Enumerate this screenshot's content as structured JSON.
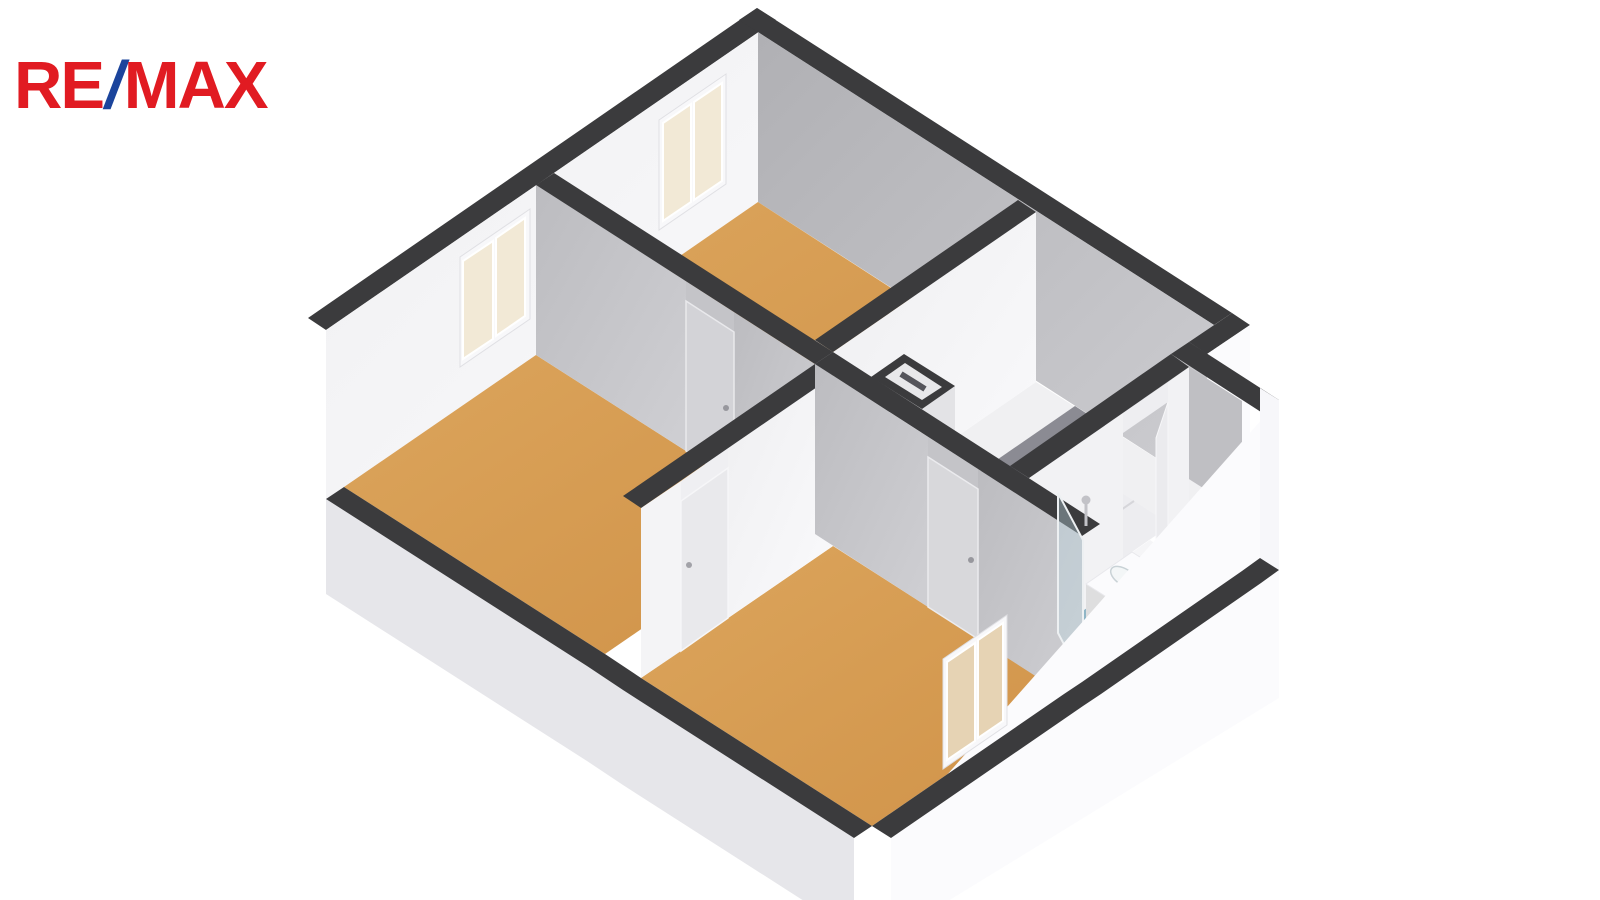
{
  "logo": {
    "re": "RE",
    "slash": "/",
    "max": "MAX"
  },
  "colors": {
    "background": "#ffffff",
    "logo_red": "#e11b22",
    "logo_blue": "#1b449c",
    "wall_top_band": "#3b3b3d",
    "wall_gray_face": "#b9b9bd",
    "wall_white_face": "#f4f4f6",
    "floor_wood": "#d59c51",
    "floor_hall": "#f0f0f2",
    "floor_bath": "#8fb5c6",
    "window_pane": "#f2e9d6",
    "skirt_gray": "#e6e6ea",
    "skirt_white": "#fbfbfd"
  },
  "floorplan": {
    "type": "3d-axonometric-floor-plan",
    "rooms": [
      {
        "id": "bedroom-top",
        "floor": "wood"
      },
      {
        "id": "bedroom-left",
        "floor": "wood"
      },
      {
        "id": "bedroom-bottom",
        "floor": "wood"
      },
      {
        "id": "hall-landing",
        "floor": "light"
      },
      {
        "id": "stairwell",
        "floor": "light",
        "feature": "winder-stairs"
      },
      {
        "id": "bathroom",
        "floor": "blue",
        "fixtures": [
          "vanity-sink",
          "toilet",
          "shower-glass-screen",
          "shower-head"
        ]
      }
    ],
    "windows": 3,
    "doors": 4
  },
  "scene": [
    {
      "n": "window-a-outer-casing",
      "t": "poly",
      "p": "706,54 632,105 632,221 706,170",
      "f": "#fdfdfe",
      "s": "#e3e3e7",
      "w": 1
    },
    {
      "n": "window-b-outer-casing",
      "t": "poly",
      "p": "509,190 433,243 433,359 509,306",
      "f": "#fdfdfe",
      "s": "#e3e3e7",
      "w": 1
    },
    {
      "n": "wall-nw-top-band",
      "t": "poly",
      "p": "757,8 776,20 326,330 308,318",
      "f": "#3b3b3d"
    },
    {
      "n": "wall-nw-interior-face",
      "t": "poly",
      "p": "776,20 326,330 326,500 776,190",
      "f": "url(#gWhiteWall)"
    },
    {
      "n": "window-a-frame",
      "t": "poly",
      "p": "726,74 659,120 659,230 726,184",
      "f": "#f8f8fa",
      "s": "#e0e0e4",
      "w": 1
    },
    {
      "n": "window-a-pane-1",
      "t": "poly",
      "p": "722,83 694,102 694,200 722,181",
      "f": "#f2e9d6",
      "s": "#ffffff",
      "w": 2
    },
    {
      "n": "window-a-pane-2",
      "t": "poly",
      "p": "691,104 663,123 663,221 691,202",
      "f": "#f2e9d6",
      "s": "#ffffff",
      "w": 2
    },
    {
      "n": "window-b-frame",
      "t": "poly",
      "p": "530,209 460,257 460,367 530,319",
      "f": "#f8f8fa",
      "s": "#e0e0e4",
      "w": 1
    },
    {
      "n": "window-b-pane-1",
      "t": "poly",
      "p": "525,218 496,238 496,336 525,316",
      "f": "#f2e9d6",
      "s": "#ffffff",
      "w": 2
    },
    {
      "n": "window-b-pane-2",
      "t": "poly",
      "p": "493,241 463,261 463,359 493,339",
      "f": "#f2e9d6",
      "s": "#ffffff",
      "w": 2
    },
    {
      "n": "wall-ne-top-band",
      "t": "poly",
      "p": "757,8 1232,313 1214,325 739,20",
      "f": "#3b3b3d"
    },
    {
      "n": "wall-ne-interior-face",
      "t": "poly",
      "p": "758,32 1214,325 1214,495 758,202",
      "f": "url(#gGrayWall)"
    },
    {
      "n": "wall-step-top-band",
      "t": "poly",
      "p": "1232,313 1250,325 1207,354 1189,342",
      "f": "#3b3b3d"
    },
    {
      "n": "wall-step-east-face",
      "t": "poly",
      "p": "1250,325 1207,354 1207,619 1250,590",
      "f": "#fbfbfd"
    },
    {
      "n": "wall-bath-north-top-band",
      "t": "poly",
      "p": "1189,342 1279,400 1261,412 1171,354",
      "f": "#3b3b3d"
    },
    {
      "n": "wall-bath-north-interior-face",
      "t": "poly",
      "p": "1189,367 1242,401 1242,571 1189,537",
      "f": "#bfbfc3"
    },
    {
      "n": "floor-bedroom-top",
      "t": "poly",
      "p": "758,202 1018,370 815,510 554,343",
      "f": "url(#gTan)"
    },
    {
      "n": "floor-bedroom-left",
      "t": "poly",
      "p": "536,355 797,522 605,654 344,487",
      "f": "url(#gTan)"
    },
    {
      "n": "floor-hall-landing",
      "t": "poly",
      "p": "1036,382 1214,495 1010,636 833,522",
      "f": "#f0f0f2"
    },
    {
      "n": "floor-bathroom",
      "t": "poly",
      "p": "1189,537 1242,571 1082,682 1029,648",
      "f": "#8fb5c6"
    },
    {
      "n": "floor-bedroom-bottom",
      "t": "poly",
      "p": "833,546 1064,694 872,826 641,678",
      "f": "url(#gTan)"
    },
    {
      "n": "bathroom-door-threshold",
      "t": "poly",
      "p": "1150,540 1168,552 1123,583 1105,571",
      "f": "#f5f5f7"
    },
    {
      "n": "stair-zone",
      "t": "poly",
      "p": "1066,457 1171,525 1010,636 905,568",
      "f": "#ededf0"
    },
    {
      "n": "stair-tread-seam-1",
      "t": "line",
      "x1": 1083,
      "y1": 468,
      "x2": 922,
      "y2": 579,
      "s": "#d6d6da",
      "w": 2
    },
    {
      "n": "stair-tread-seam-2",
      "t": "line",
      "x1": 1100,
      "y1": 479,
      "x2": 939,
      "y2": 590,
      "s": "#d6d6da",
      "w": 2
    },
    {
      "n": "stair-tread-seam-3",
      "t": "line",
      "x1": 1117,
      "y1": 490,
      "x2": 956,
      "y2": 601,
      "s": "#d6d6da",
      "w": 2
    },
    {
      "n": "stair-tread-seam-4",
      "t": "line",
      "x1": 1134,
      "y1": 501,
      "x2": 973,
      "y2": 612,
      "s": "#d6d6da",
      "w": 2
    },
    {
      "n": "stair-winder-seam-1",
      "t": "line",
      "x1": 993,
      "y1": 614,
      "x2": 963,
      "y2": 529,
      "s": "#d9d9dd",
      "w": 2
    },
    {
      "n": "stair-winder-seam-2",
      "t": "line",
      "x1": 993,
      "y1": 614,
      "x2": 930,
      "y2": 551,
      "s": "#d9d9dd",
      "w": 2
    },
    {
      "n": "stair-winder-seam-3",
      "t": "line",
      "x1": 993,
      "y1": 614,
      "x2": 922,
      "y2": 579,
      "s": "#d9d9dd",
      "w": 2
    },
    {
      "n": "stair-winder-seam-4",
      "t": "line",
      "x1": 993,
      "y1": 614,
      "x2": 956,
      "y2": 601,
      "s": "#d9d9dd",
      "w": 2
    },
    {
      "n": "stairwell-void",
      "t": "poly",
      "p": "1075,406 1109,428 995,506 962,484",
      "f": "#8b8b93"
    },
    {
      "n": "stairwell-stringer",
      "t": "line",
      "x1": 964,
      "y1": 480,
      "x2": 997,
      "y2": 502,
      "s": "#ffffff",
      "w": 4
    },
    {
      "n": "wall-w1-end-face",
      "t": "poly",
      "p": "815,340 833,352 833,522 815,510",
      "f": "#c6c6c9"
    },
    {
      "n": "wall-w1-east-face",
      "t": "poly",
      "p": "1036,212 833,352 833,522 1036,382",
      "f": "url(#gWhiteWall)"
    },
    {
      "n": "wall-w1-top-band",
      "t": "poly",
      "p": "1018,200 1036,212 833,352 815,340",
      "f": "#3b3b3d"
    },
    {
      "n": "wall-h1-face-left",
      "t": "poly",
      "p": "536,185 686,281 686,451 536,355",
      "f": "url(#gGrayWall2)"
    },
    {
      "n": "wall-h1-face-right",
      "t": "poly",
      "p": "734,312 815,364 815,534 734,482",
      "f": "url(#gGrayWall2)"
    },
    {
      "n": "wall-h1-face-over-door",
      "t": "poly",
      "p": "686,281 734,312 734,332 686,301",
      "f": "#c4c4c8"
    },
    {
      "n": "door-1-slab",
      "t": "poly",
      "p": "686,301 734,332 734,482 686,451",
      "f": "#d3d3d7",
      "s": "#e9e9ec",
      "w": 1.5
    },
    {
      "n": "door-1-handle",
      "t": "ellipse",
      "cx": 726,
      "cy": 408,
      "rx": 3,
      "ry": 3,
      "f": "#97979d"
    },
    {
      "n": "wall-h1-top-band",
      "t": "poly",
      "p": "554,173 833,352 815,364 536,185",
      "f": "#3b3b3d"
    },
    {
      "n": "shaft-east-face",
      "t": "poly",
      "p": "955,386 922,409 922,579 955,556",
      "f": "#e3e3e6"
    },
    {
      "n": "shaft-top-band",
      "t": "poly",
      "p": "904,354 955,386 922,409 871,377",
      "f": "#3b3b3d"
    },
    {
      "n": "shaft-inner-top",
      "t": "poly",
      "p": "905,363 942,387 922,400 885,377",
      "f": "#e8e8ea"
    },
    {
      "n": "shaft-inner-slot",
      "t": "line",
      "x1": 901,
      "y1": 374,
      "x2": 925,
      "y2": 389,
      "s": "#55555b",
      "w": 6
    },
    {
      "n": "wall-bath-west-face-north",
      "t": "poly",
      "p": "1189,367 1168,382 1168,552 1189,537",
      "f": "#f2f2f4"
    },
    {
      "n": "wall-bath-west-face-south",
      "t": "poly",
      "p": "1123,413 1029,478 1029,648 1123,583",
      "f": "#f2f2f4"
    },
    {
      "n": "wall-bath-west-face-over-door",
      "t": "poly",
      "p": "1168,382 1123,413 1123,433 1168,402",
      "f": "#eeeef1"
    },
    {
      "n": "door-4-bathroom-slab",
      "t": "poly",
      "p": "1168,402 1156,438 1156,588 1168,552",
      "f": "#ebebee",
      "s": "#f7f7f9",
      "w": 1
    },
    {
      "n": "wall-bath-west-top-band",
      "t": "poly",
      "p": "1171,354 1189,367 1029,478 1010,466",
      "f": "#3b3b3d"
    },
    {
      "n": "vanity-west-face",
      "t": "poly",
      "p": "1132,552 1086,584 1086,639 1132,607",
      "f": "#e9e9ed"
    },
    {
      "n": "vanity-south-face",
      "t": "poly",
      "p": "1086,584 1116,603 1116,658 1086,639",
      "f": "#dededf"
    },
    {
      "n": "vanity-top",
      "t": "poly",
      "p": "1132,552 1162,571 1116,603 1086,584",
      "f": "#fbfbfd",
      "s": "#e8e8ec",
      "w": 1
    },
    {
      "n": "vanity-basin",
      "t": "ellipse",
      "cx": 1124,
      "cy": 577,
      "rx": 15,
      "ry": 8,
      "rot": 33,
      "f": "#f3f6f7",
      "s": "#c9d2d6",
      "w": 1.5
    },
    {
      "n": "vanity-faucet",
      "t": "ellipse",
      "cx": 1137,
      "cy": 567,
      "rx": 2.5,
      "ry": 2.5,
      "f": "#b4bac0"
    },
    {
      "n": "toilet-tank",
      "t": "poly",
      "p": "1184,550 1197,558 1190,570 1177,562",
      "f": "#f0f0f3",
      "s": "#dcdce0",
      "w": 1
    },
    {
      "n": "toilet-bowl",
      "t": "ellipse",
      "cx": 1174,
      "cy": 566,
      "rx": 12,
      "ry": 7.5,
      "rot": 33,
      "f": "#ffffff",
      "s": "#d5d5d9",
      "w": 1.5
    },
    {
      "n": "wall-wb-east-face-north",
      "t": "poly",
      "p": "833,376 728,448 728,618 833,546",
      "f": "url(#gWhiteWall)"
    },
    {
      "n": "wall-wb-east-face-south",
      "t": "poly",
      "p": "681,481 641,508 641,678 681,651",
      "f": "#f4f4f6"
    },
    {
      "n": "wall-wb-face-over-door",
      "t": "poly",
      "p": "728,448 681,481 681,501 728,468",
      "f": "#efeff2"
    },
    {
      "n": "door-2-slab",
      "t": "poly",
      "p": "728,468 681,501 681,651 728,618",
      "f": "#e9e9ec",
      "s": "#f6f6f8",
      "w": 1.5
    },
    {
      "n": "door-2-handle",
      "t": "ellipse",
      "cx": 689,
      "cy": 565,
      "rx": 3,
      "ry": 3,
      "f": "#a2a2a8"
    },
    {
      "n": "wall-wb-top-band",
      "t": "poly",
      "p": "815,364 833,376 641,508 623,496",
      "f": "#3b3b3d"
    },
    {
      "n": "wall-h2-face-left",
      "t": "poly",
      "p": "815,364 928,437 928,607 815,534",
      "f": "url(#gGrayWall2)"
    },
    {
      "n": "wall-h2-face-right",
      "t": "poly",
      "p": "978,469 1082,536 1082,706 978,639",
      "f": "url(#gGrayWall2)"
    },
    {
      "n": "wall-h2-face-over-door",
      "t": "poly",
      "p": "928,437 978,469 978,489 928,457",
      "f": "#c4c4c8"
    },
    {
      "n": "door-3-slab",
      "t": "poly",
      "p": "928,457 978,489 978,639 928,607",
      "f": "#d8d8db",
      "s": "#ebebee",
      "w": 1.5
    },
    {
      "n": "door-3-handle",
      "t": "ellipse",
      "cx": 971,
      "cy": 560,
      "rx": 3,
      "ry": 3,
      "f": "#97979d"
    },
    {
      "n": "wall-h2-top-band",
      "t": "poly",
      "p": "833,352 1100,524 1082,536 815,364",
      "f": "#3b3b3d"
    },
    {
      "n": "shower-glass-screen",
      "t": "poly",
      "p": "1058,493 1083,540 1083,680 1058,633",
      "f": "rgba(186,212,224,0.38)",
      "s": "#edf0f2",
      "w": 2
    },
    {
      "n": "shower-head",
      "t": "ellipse",
      "cx": 1086,
      "cy": 500,
      "rx": 4.5,
      "ry": 4.5,
      "f": "#c2c2c7"
    },
    {
      "n": "shower-pipe",
      "t": "line",
      "x1": 1086,
      "y1": 504,
      "x2": 1086,
      "y2": 526,
      "s": "#c2c2c7",
      "w": 3
    },
    {
      "n": "wall-sw-skirt",
      "t": "poly",
      "p": "326,499 587,666 623,690 854,838 854,933 623,785 587,761 326,594",
      "f": "#e6e6ea"
    },
    {
      "n": "wall-sw-top-band",
      "t": "poly",
      "p": "344,487 605,654 641,678 872,826 854,838 623,690 587,666 326,499",
      "f": "#3b3b3d"
    },
    {
      "n": "wall-se-skirt",
      "t": "poly",
      "p": "1279,400 891,838 891,936 1279,698",
      "f": "#fbfbfd"
    },
    {
      "n": "wall-se-corner-face",
      "t": "poly",
      "p": "1260,388 1279,400 1279,570 1260,558",
      "f": "#f7f7fa"
    },
    {
      "n": "wall-se-top-band",
      "t": "poly",
      "p": "1260,558 1242,571 1082,682 1064,694 872,826 891,838 1083,706 1101,694 1261,583 1279,570",
      "f": "#3b3b3d"
    },
    {
      "n": "window-c-frame",
      "t": "poly",
      "p": "1007,615 943,659 943,769 1007,725",
      "f": "#f8f8fa",
      "s": "#e0e0e4",
      "w": 1
    },
    {
      "n": "window-c-pane-1",
      "t": "poly",
      "p": "1003,623 978,640 978,738 1003,721",
      "f": "#e6d3b4",
      "s": "#ffffff",
      "w": 2
    },
    {
      "n": "window-c-pane-2",
      "t": "poly",
      "p": "975,643 947,662 947,760 975,741",
      "f": "#e6d3b4",
      "s": "#ffffff",
      "w": 2
    }
  ]
}
